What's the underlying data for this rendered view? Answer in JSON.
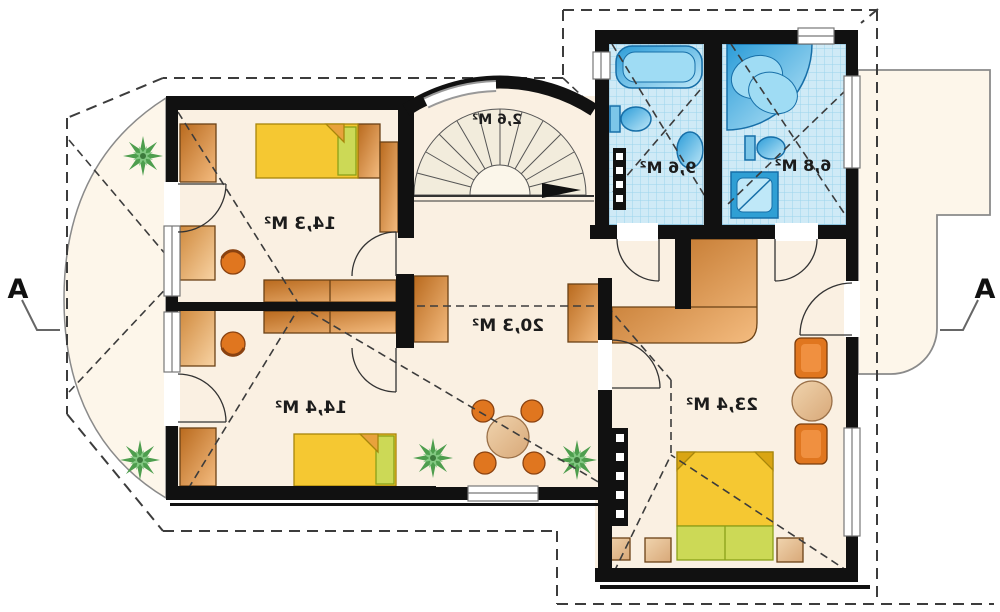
{
  "drawing": {
    "type": "architectural floor plan",
    "orientation": "mirrored print (labels reversed)",
    "section_marker_left": "A",
    "section_marker_right": "A"
  },
  "rooms": {
    "bedroom1": {
      "label": "14,3 M²",
      "features": "single bed, desk with chair, wardrobes, balcony door"
    },
    "bedroom2": {
      "label": "14,4 M²",
      "features": "single bed, desk with chair, wardrobe, balcony door"
    },
    "hall": {
      "label": "20,3 M²",
      "features": "round table with four chairs, plants, built-in wardrobes"
    },
    "master_bedroom": {
      "label": "23,4 M²",
      "features": "double bed, nightstands, two armchairs, round side table, corner wardrobe, terrace door"
    },
    "bathroom1": {
      "label": "9,6 M²",
      "features": "bathtub, toilet, washbasin"
    },
    "bathroom2": {
      "label": "6,8 M²",
      "features": "corner bathtub, toilet, shower"
    },
    "staircase": {
      "label": "2,6 M²",
      "features": "curved winder stair with direction arrow"
    },
    "balcony": {
      "features": "curved balcony with two plants"
    },
    "terrace": {
      "features": "terrace with rounded corner"
    }
  },
  "colors": {
    "wall": "#111111",
    "floor": "#faf0e2",
    "outside": "#fdf6ea",
    "tile_bg": "#cfeaf6",
    "tile_grid": "#9bd4ec",
    "fixture_blue": "#3aa8dc",
    "wood_dark": "#c2731f",
    "wood_light": "#f2b879",
    "bed_yellow": "#f5c832",
    "pillow_green": "#ccd956",
    "chair_orange": "#e0761f",
    "table_tan": "#ecc9a0",
    "plant_green": "#4e9e4e",
    "dash_line": "#3c3c3c"
  }
}
